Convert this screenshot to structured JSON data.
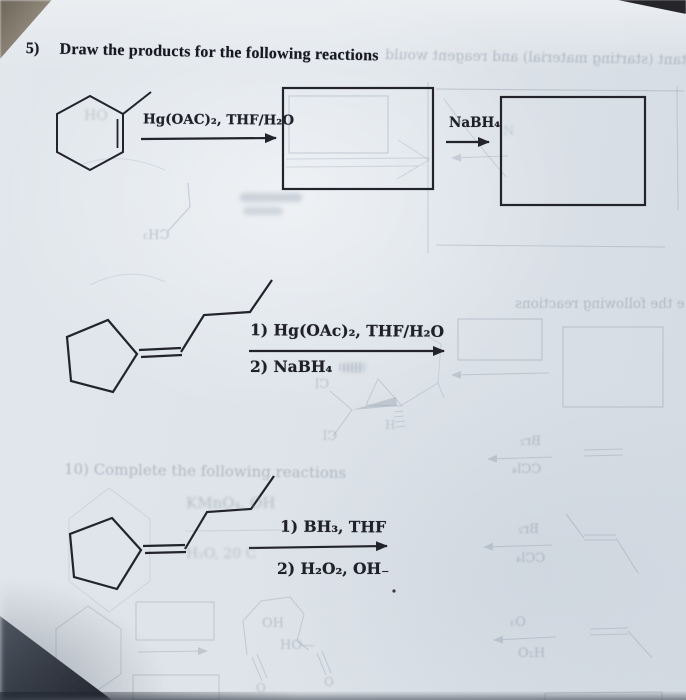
{
  "page": {
    "problem_number": "5)",
    "title": "Draw the products for the following reactions"
  },
  "reaction1": {
    "reagent": "Hg(OAC)₂, THF/H₂O",
    "step2_reagent": "NaBH₄"
  },
  "reaction2": {
    "step1": "1) Hg(OAc)₂, THF/H₂O",
    "step2": "2) NaBH₄"
  },
  "reaction3": {
    "step1": "1) BH₃, THF",
    "step2": "2) H₂O₂, OH₋"
  },
  "ghost_bleedthrough": {
    "title_line": "reactant (starting material) and reagent would",
    "following_reactions": "e the following reactions",
    "complete_heading": "10) Complete the following reactions",
    "kmno4": "KMnO₄, OH",
    "h2o_20c": "H₂O, 20 C",
    "ho": "HO",
    "ch3": "CH₃",
    "n": "N",
    "cl": "Cl",
    "h": "H",
    "br2": "Br₂",
    "ccl4": "CCl₄",
    "oh": "OH",
    "ho_dash": "HO—",
    "o": "O",
    "o3": "O₃",
    "h2o": "H₂O"
  },
  "colors": {
    "paper": "#dde3e9",
    "ink": "#23232b",
    "ghost": "#9aa6b4",
    "shadow_corner": "#2c323c",
    "table_corner": "#8d8274"
  }
}
